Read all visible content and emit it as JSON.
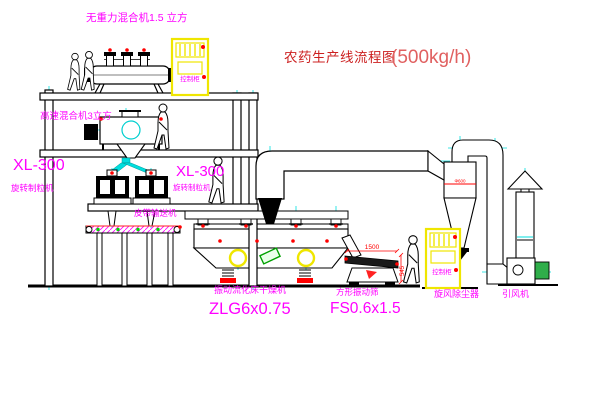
{
  "title": {
    "text": "农药生产线流程图",
    "capacity": "(500kg/h)"
  },
  "labels": {
    "gravity_mixer": "无重力混合机1.5 立方",
    "high_speed_mixer": "高速混合机3立方",
    "granulator_left_model": "XL-300",
    "granulator_left_name": "旋转制粒机",
    "granulator_right_model": "XL-300",
    "granulator_right_name": "旋转制粒机",
    "belt_conveyor": "皮带输送机",
    "dryer_name": "振动流化床干燥机",
    "dryer_model": "ZLG6x0.75",
    "screen_name": "方形振动筛",
    "screen_model": "FS0.6x1.5",
    "cyclone": "旋风除尘器",
    "fan": "引风机",
    "cabinet_top": "控制柜",
    "cabinet_right": "控制柜"
  },
  "dimensions": {
    "screen_length": "1500",
    "screen_height": "545",
    "cyclone_dia": "Φ600"
  },
  "colors": {
    "label_magenta": "#ff00ff",
    "title_red": "#cc2020",
    "capacity_red": "#e06060",
    "centerline_cyan": "#00dede",
    "cabinet_yellow": "#efe600",
    "flange_red": "#ff0000",
    "conveyor_green": "#00d500",
    "motor_green": "#2fae4a"
  }
}
